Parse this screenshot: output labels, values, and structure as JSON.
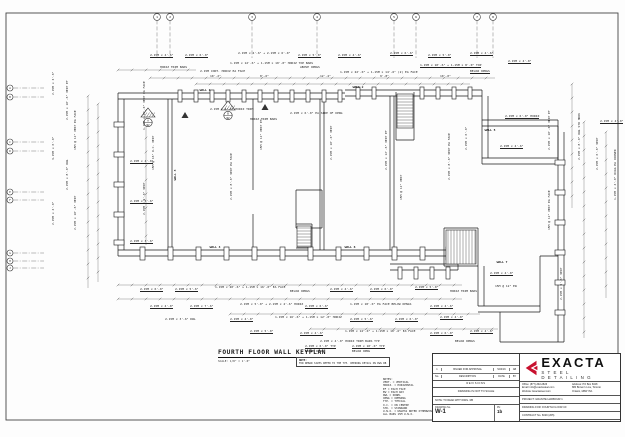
{
  "sheet": {
    "title": "FOURTH FLOOR WALL KEYPLAN",
    "scale": "SCALE:   1/8\" = 1'-0\"",
    "note_title": "NOTE:",
    "note_text": "FOR REBAR SIZES REFER TO THE TYP. OPENING DETAIL ON DWG RB"
  },
  "legend": {
    "lines": [
      "NOTES:",
      "VERT.  = VERTICAL",
      "HORIZ. = HORIZONTAL",
      "EF  = EACH FACE",
      "EW  = EACH WAY",
      "DWL = DOWEL",
      "OPNG = OPENING",
      "TYP. = TYPICAL",
      "O.C. = ON CENTRE",
      "STD. = STANDARD",
      "U.N.O. = UNLESS NOTED OTHERWISE",
      "ALL BARS 15M U.N.O."
    ]
  },
  "title_block": {
    "rev_row": {
      "no": "1",
      "desc": "ISSUED FOR APPROVAL",
      "date": "5/24/16",
      "by": "AB"
    },
    "header": {
      "no": "No.",
      "desc": "DESCRIPTION",
      "date": "DATE",
      "by": "BY"
    },
    "revisions": "REVISIONS",
    "scale_note": "DRAWING IS NOT TO SCALE",
    "read_note": "NOTE: TO READ WITH DWG. RB",
    "dwg_label": "DRAWING No.",
    "dwg_no": "W-1",
    "rev_label": "RV.",
    "rev_val": "1b"
  },
  "logo": {
    "name": "EXACTA",
    "tagline": "STEEL DETAILING",
    "accent": "#c8102e"
  },
  "contact": {
    "office": "Office: (877)-392-2826",
    "email": "Email: info@exactasteel.com",
    "website": "Website: Exactasteel.com",
    "address1": "Address: PO Box 6028",
    "address2": "880 Brown's Line, Toronto",
    "address3": "Ontario, M8W 3V1"
  },
  "project": {
    "project": "PROJECT: GRANITE HARBOUR 1",
    "drawing_for": "DRAWING FOR: FOURTH FLOOR CF",
    "contract": "CONTRACT No. 6029 (205)",
    "customer": "CUSTOMER: ONTARIO REBAR INC."
  },
  "drawing": {
    "border": [
      6,
      13,
      612,
      407
    ],
    "walls": [
      [
        118,
        93,
        345,
        93
      ],
      [
        118,
        99,
        345,
        99
      ],
      [
        345,
        90,
        482,
        90
      ],
      [
        345,
        96,
        482,
        96
      ],
      [
        118,
        93,
        118,
        256
      ],
      [
        124,
        99,
        124,
        250
      ],
      [
        118,
        250,
        458,
        250
      ],
      [
        118,
        256,
        458,
        256
      ],
      [
        168,
        99,
        168,
        250
      ],
      [
        172,
        99,
        172,
        250
      ],
      [
        253,
        99,
        253,
        190
      ],
      [
        253,
        214,
        253,
        250
      ],
      [
        320,
        99,
        320,
        250
      ],
      [
        324,
        99,
        324,
        250
      ],
      [
        390,
        96,
        390,
        250
      ],
      [
        394,
        96,
        394,
        250
      ],
      [
        296,
        190,
        322,
        190
      ],
      [
        296,
        190,
        296,
        228
      ],
      [
        322,
        190,
        322,
        228
      ],
      [
        296,
        228,
        322,
        228
      ],
      [
        296,
        224,
        312,
        224
      ],
      [
        312,
        224,
        312,
        248
      ],
      [
        296,
        248,
        312,
        248
      ],
      [
        396,
        92,
        396,
        140
      ],
      [
        414,
        92,
        414,
        140
      ],
      [
        396,
        140,
        414,
        140
      ],
      [
        482,
        90,
        482,
        164
      ],
      [
        488,
        96,
        488,
        158
      ],
      [
        482,
        120,
        558,
        120
      ],
      [
        482,
        126,
        558,
        126
      ],
      [
        558,
        120,
        558,
        164
      ],
      [
        482,
        158,
        558,
        158
      ],
      [
        482,
        164,
        558,
        164
      ],
      [
        558,
        126,
        558,
        342
      ],
      [
        564,
        132,
        564,
        342
      ],
      [
        500,
        342,
        564,
        342
      ],
      [
        390,
        264,
        458,
        264
      ],
      [
        390,
        270,
        458,
        270
      ],
      [
        458,
        250,
        458,
        270
      ],
      [
        444,
        228,
        478,
        228
      ],
      [
        444,
        228,
        444,
        266
      ],
      [
        478,
        228,
        478,
        266
      ],
      [
        444,
        266,
        478,
        266
      ],
      [
        478,
        266,
        478,
        306
      ],
      [
        484,
        266,
        484,
        306
      ],
      [
        478,
        306,
        540,
        306
      ],
      [
        478,
        312,
        540,
        312
      ],
      [
        540,
        256,
        540,
        312
      ],
      [
        540,
        256,
        558,
        256
      ],
      [
        500,
        312,
        500,
        342
      ]
    ],
    "pilasters": [
      [
        178,
        90,
        4,
        12
      ],
      [
        194,
        90,
        4,
        12
      ],
      [
        210,
        90,
        4,
        12
      ],
      [
        226,
        90,
        4,
        12
      ],
      [
        242,
        90,
        4,
        12
      ],
      [
        258,
        90,
        4,
        12
      ],
      [
        274,
        90,
        4,
        12
      ],
      [
        290,
        90,
        4,
        12
      ],
      [
        306,
        90,
        4,
        12
      ],
      [
        322,
        90,
        4,
        12
      ],
      [
        338,
        90,
        4,
        12
      ],
      [
        356,
        87,
        4,
        12
      ],
      [
        372,
        87,
        4,
        12
      ],
      [
        420,
        87,
        4,
        12
      ],
      [
        436,
        87,
        4,
        12
      ],
      [
        452,
        87,
        4,
        12
      ],
      [
        468,
        87,
        4,
        12
      ],
      [
        140,
        247,
        5,
        13
      ],
      [
        168,
        247,
        5,
        13
      ],
      [
        196,
        247,
        5,
        13
      ],
      [
        224,
        247,
        5,
        13
      ],
      [
        252,
        247,
        5,
        13
      ],
      [
        280,
        247,
        5,
        13
      ],
      [
        308,
        247,
        5,
        13
      ],
      [
        336,
        247,
        5,
        13
      ],
      [
        364,
        247,
        5,
        13
      ],
      [
        392,
        247,
        5,
        13
      ],
      [
        420,
        247,
        5,
        13
      ],
      [
        446,
        247,
        5,
        13
      ],
      [
        114,
        122,
        10,
        5
      ],
      [
        114,
        152,
        10,
        5
      ],
      [
        114,
        182,
        10,
        5
      ],
      [
        114,
        212,
        10,
        5
      ],
      [
        114,
        240,
        10,
        5
      ],
      [
        398,
        267,
        4,
        12
      ],
      [
        414,
        267,
        4,
        12
      ],
      [
        430,
        267,
        4,
        12
      ],
      [
        446,
        267,
        4,
        12
      ],
      [
        555,
        160,
        10,
        5
      ],
      [
        555,
        190,
        10,
        5
      ],
      [
        555,
        220,
        10,
        5
      ],
      [
        555,
        250,
        10,
        5
      ],
      [
        555,
        280,
        10,
        5
      ],
      [
        555,
        310,
        10,
        5
      ]
    ],
    "dims": [
      [
        150,
        78,
        495,
        78
      ],
      [
        196,
        84,
        470,
        84
      ],
      [
        118,
        70,
        196,
        70
      ],
      [
        118,
        285,
        462,
        285
      ],
      [
        118,
        299,
        462,
        299
      ],
      [
        230,
        314,
        480,
        314
      ],
      [
        310,
        329,
        498,
        329
      ],
      [
        88,
        96,
        88,
        288
      ],
      [
        98,
        104,
        98,
        282
      ],
      [
        146,
        110,
        146,
        245
      ],
      [
        572,
        84,
        572,
        208
      ],
      [
        584,
        122,
        584,
        338
      ],
      [
        606,
        132,
        606,
        298
      ]
    ],
    "bubbles_top": {
      "y": 17,
      "leader_to": 58,
      "items": [
        {
          "x": 157,
          "label": "1"
        },
        {
          "x": 170,
          "label": "2"
        },
        {
          "x": 252,
          "label": "3"
        },
        {
          "x": 317,
          "label": "4"
        },
        {
          "x": 394,
          "label": "5"
        },
        {
          "x": 416,
          "label": "6"
        },
        {
          "x": 477,
          "label": "7"
        },
        {
          "x": 493,
          "label": "8"
        }
      ]
    },
    "bubbles_left": {
      "x": 10,
      "leader_to": 44,
      "items": [
        {
          "y": 88,
          "label": "A"
        },
        {
          "y": 97,
          "label": "B"
        },
        {
          "y": 142,
          "label": "C"
        },
        {
          "y": 151,
          "label": "D"
        },
        {
          "y": 192,
          "label": "E"
        },
        {
          "y": 200,
          "label": "F"
        },
        {
          "y": 253,
          "label": "G"
        },
        {
          "y": 261,
          "label": "H"
        },
        {
          "y": 268,
          "label": "J"
        }
      ]
    },
    "triangles": [
      [
        185,
        112
      ],
      [
        265,
        104
      ]
    ],
    "markers": [
      {
        "x": 148,
        "y": 108,
        "top": "A",
        "bot": "W2"
      },
      {
        "x": 228,
        "y": 101,
        "top": "B",
        "bot": "W2"
      }
    ],
    "stairs": [
      {
        "x": 397,
        "y": 94,
        "w": 16,
        "h": 34,
        "dir": "h"
      },
      {
        "x": 297,
        "y": 226,
        "w": 14,
        "h": 21,
        "dir": "h"
      },
      {
        "x": 446,
        "y": 230,
        "w": 30,
        "h": 34,
        "dir": "v"
      }
    ],
    "wall_labels": [
      [
        205,
        91,
        "WALL 1",
        0
      ],
      [
        358,
        88,
        "WALL 2",
        0
      ],
      [
        176,
        175,
        "WALL 3",
        -90
      ],
      [
        215,
        248,
        "WALL 4",
        0
      ],
      [
        490,
        131,
        "WALL 5",
        0
      ],
      [
        350,
        248,
        "WALL 6",
        0
      ],
      [
        502,
        263,
        "WALL 7",
        0
      ]
    ],
    "callouts": [
      [
        150,
        54,
        0,
        1,
        "2-15M x 4'-6\""
      ],
      [
        185,
        54,
        0,
        1,
        "2-15M x 6'-0\""
      ],
      [
        238,
        52,
        0,
        0,
        "2-15M x 4'-6\" + 2-15M x 6'-0\""
      ],
      [
        298,
        54,
        0,
        1,
        "2-15M x 5'-0\""
      ],
      [
        338,
        54,
        0,
        1,
        "2-15M x 4'-6\""
      ],
      [
        390,
        52,
        0,
        1,
        "2-15M x 6'-6\""
      ],
      [
        428,
        54,
        0,
        1,
        "2-15M x 5'-0\""
      ],
      [
        470,
        52,
        0,
        1,
        "2-15M x 4'-6\""
      ],
      [
        508,
        60,
        0,
        1,
        "2-15M x 4'-0\""
      ],
      [
        230,
        62,
        0,
        0,
        "1-15M x 12'-6\" + 1-15M x 10'-0\" HORIZ TOP BARS"
      ],
      [
        160,
        66,
        0,
        0,
        "HORIZ TRIM BARS"
      ],
      [
        300,
        66,
        0,
        0,
        "ABOVE OPNGS"
      ],
      [
        420,
        64,
        0,
        1,
        "1-15M x 10'-6\" + 1-15M x 8'-0\" TOP"
      ],
      [
        200,
        70,
        0,
        0,
        "2-15M CONT. HORIZ EA FACE"
      ],
      [
        340,
        71,
        0,
        0,
        "1-15M x 22'-0\" + 1-15M x 14'-6\" (2) EA FACE"
      ],
      [
        470,
        70,
        0,
        1,
        "BELOW OPNGS"
      ],
      [
        210,
        75,
        0,
        0,
        "10'-2\""
      ],
      [
        260,
        75,
        0,
        0,
        "8'-6\""
      ],
      [
        320,
        75,
        0,
        0,
        "12'-4\""
      ],
      [
        380,
        75,
        0,
        0,
        "9'-8\""
      ],
      [
        440,
        75,
        0,
        0,
        "10'-0\""
      ],
      [
        66,
        120,
        -90,
        0,
        "2-15M x 10'-6\" VERT EF"
      ],
      [
        74,
        150,
        -90,
        0,
        "15M @ 12\" VERT EA FACE"
      ],
      [
        66,
        190,
        -90,
        0,
        "2-15M x 8'-0\" DWL"
      ],
      [
        74,
        230,
        -90,
        0,
        "2-15M x 10'-6\" VERT"
      ],
      [
        52,
        95,
        -90,
        0,
        "2-15M x 3'-6\""
      ],
      [
        52,
        160,
        -90,
        0,
        "3-15M x 6'-0\""
      ],
      [
        52,
        225,
        -90,
        0,
        "2-15M x 4'-0\""
      ],
      [
        143,
        130,
        -90,
        0,
        "1-15M x 12'-0\" VERT EA FACE"
      ],
      [
        152,
        170,
        -90,
        0,
        "15M @ 16\" O.C. VERT"
      ],
      [
        143,
        215,
        -90,
        0,
        "2-15M x 9'-6\" VERT"
      ],
      [
        210,
        108,
        0,
        0,
        "2-15M x 4'-6\" HORIZ TRIM"
      ],
      [
        290,
        112,
        0,
        0,
        "2-15M x 6'-0\" EA SIDE OF OPNG"
      ],
      [
        250,
        118,
        0,
        0,
        "HORIZ TRIM BARS"
      ],
      [
        130,
        160,
        0,
        1,
        "2-15M x 4'-0\""
      ],
      [
        130,
        200,
        0,
        1,
        "2-15M x 5'-6\""
      ],
      [
        130,
        240,
        0,
        1,
        "2-15M x 3'-6\""
      ],
      [
        260,
        150,
        -90,
        0,
        "15M @ 12\" VERT EF"
      ],
      [
        330,
        160,
        -90,
        0,
        "2-15M x 10'-0\" VERT"
      ],
      [
        230,
        200,
        -90,
        0,
        "2-15M x 8'-6\" VERT EA FACE"
      ],
      [
        385,
        170,
        -90,
        0,
        "2-15M x 12'-6\" VERT EF"
      ],
      [
        400,
        200,
        -90,
        0,
        "15M @ 12\" VERT"
      ],
      [
        448,
        180,
        -90,
        0,
        "2-15M x 8'-6\" VERT EA FACE"
      ],
      [
        465,
        150,
        -90,
        0,
        "2-15M x 6'-0\""
      ],
      [
        505,
        115,
        0,
        1,
        "2-15M x 6'-0\" HORIZ"
      ],
      [
        500,
        145,
        0,
        1,
        "2-15M x 4'-6\""
      ],
      [
        600,
        120,
        0,
        1,
        "2-15M x 4'-0\""
      ],
      [
        548,
        150,
        -90,
        0,
        "2-15M x 10'-0\" VERT EF"
      ],
      [
        548,
        230,
        -90,
        0,
        "15M @ 12\" VERT EA FACE"
      ],
      [
        578,
        160,
        -90,
        0,
        "2-15M x 8'-0\" DWL STD HOOK"
      ],
      [
        596,
        170,
        -90,
        0,
        "2-15M x 6'-6\" VERT"
      ],
      [
        614,
        200,
        -90,
        0,
        "1-15M x 4'-0\" DIAG EA CORNER"
      ],
      [
        560,
        300,
        -90,
        0,
        "2-15M x 5'-6\" VERT"
      ],
      [
        490,
        272,
        0,
        1,
        "2-15M x 4'-0\""
      ],
      [
        495,
        285,
        0,
        0,
        "15M @ 12\" EW"
      ],
      [
        140,
        288,
        0,
        1,
        "2-15M x 6'-0\""
      ],
      [
        175,
        288,
        0,
        1,
        "2-15M x 5'-6\""
      ],
      [
        215,
        286,
        0,
        0,
        "1-15M x 20'-6\" + 1-15M x 16'-0\" EA FACE"
      ],
      [
        290,
        290,
        0,
        0,
        "BELOW OPNGS"
      ],
      [
        330,
        288,
        0,
        1,
        "2-15M x 4'-6\""
      ],
      [
        370,
        288,
        0,
        1,
        "2-15M x 6'-0\""
      ],
      [
        415,
        286,
        0,
        1,
        "2-15M x 5'-0\""
      ],
      [
        450,
        290,
        0,
        0,
        "HORIZ TRIM BARS"
      ],
      [
        150,
        305,
        0,
        1,
        "2-15M x 4'-0\""
      ],
      [
        190,
        305,
        0,
        1,
        "2-15M x 7'-6\""
      ],
      [
        240,
        303,
        0,
        0,
        "2-15M x 5'-0\" + 2-15M x 4'-6\" HORIZ"
      ],
      [
        305,
        305,
        0,
        1,
        "2-15M x 6'-6\""
      ],
      [
        350,
        303,
        0,
        0,
        "1-15M x 18'-0\" EA FACE BELOW OPNGS"
      ],
      [
        430,
        305,
        0,
        1,
        "2-15M x 4'-6\""
      ],
      [
        165,
        318,
        0,
        0,
        "2-15M x 3'-6\" DWL"
      ],
      [
        230,
        318,
        0,
        1,
        "2-15M x 4'-0\""
      ],
      [
        275,
        316,
        0,
        0,
        "1-15M x 16'-6\" + 1-15M x 12'-0\" HORIZ"
      ],
      [
        350,
        318,
        0,
        1,
        "2-15M x 5'-6\""
      ],
      [
        395,
        318,
        0,
        1,
        "2-15M x 6'-0\""
      ],
      [
        440,
        316,
        0,
        1,
        "2-15M x 4'-0\""
      ],
      [
        250,
        330,
        0,
        1,
        "2-15M x 5'-0\""
      ],
      [
        300,
        332,
        0,
        1,
        "2-15M x 4'-6\""
      ],
      [
        345,
        330,
        0,
        0,
        "1-15M x 14'-0\" + 1-15M x 10'-6\" EA FACE"
      ],
      [
        430,
        332,
        0,
        1,
        "2-15M x 6'-0\""
      ],
      [
        470,
        330,
        0,
        1,
        "2-15M x 4'-6\""
      ],
      [
        320,
        340,
        0,
        0,
        "2-15M x 4'-0\" HORIZ TRIM BARS TYP"
      ],
      [
        455,
        340,
        0,
        0,
        "BELOW OPNGS"
      ],
      [
        305,
        345,
        0,
        1,
        "2-15M x 6'-0\" TYP"
      ],
      [
        352,
        345,
        0,
        1,
        "2-15M x 10'-0\" TYP"
      ],
      [
        305,
        350,
        0,
        0,
        "ABOVE OPNG"
      ],
      [
        352,
        350,
        0,
        0,
        "BELOW OPNG"
      ]
    ]
  }
}
